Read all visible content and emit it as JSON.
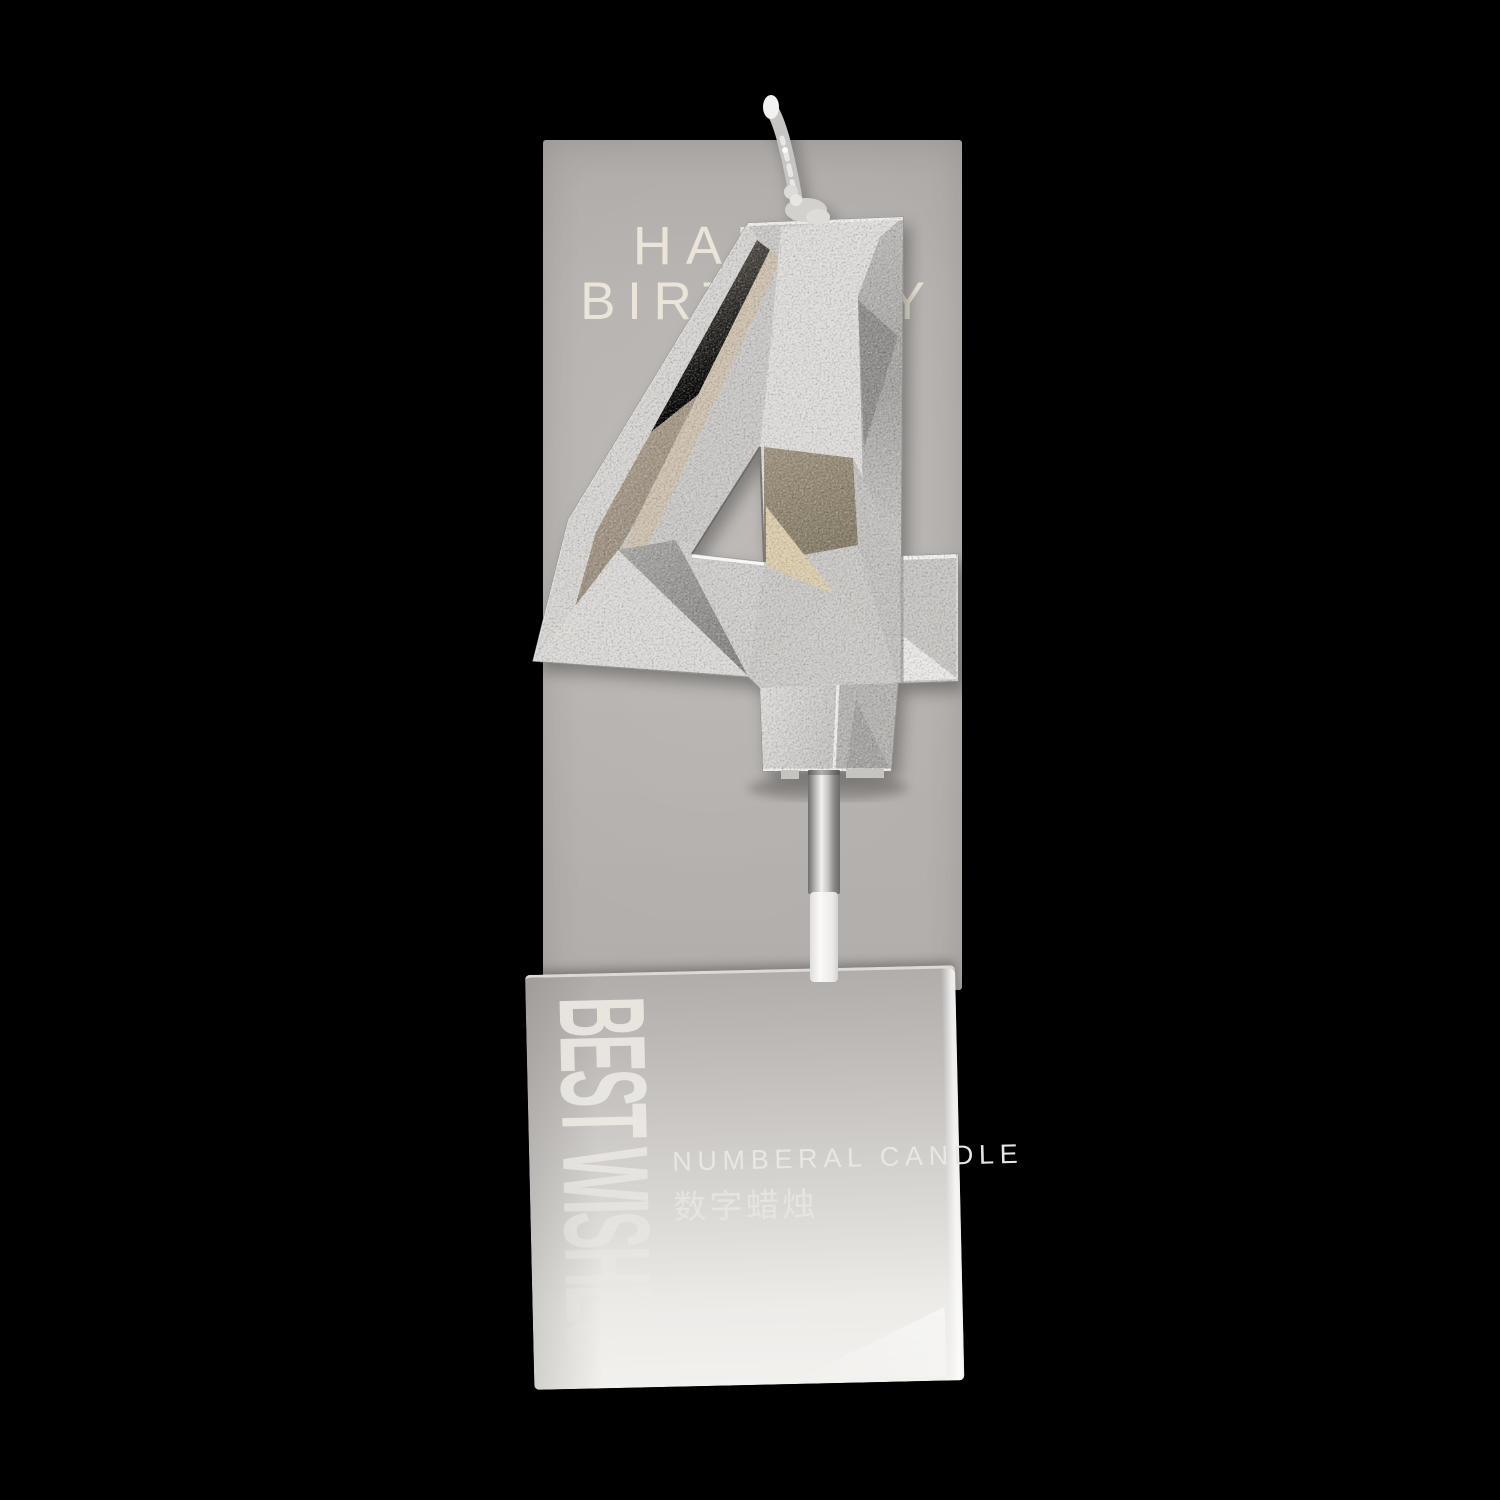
{
  "scene": {
    "background_color": "#000000"
  },
  "card": {
    "color": "#b5b1ae",
    "heading_line1": "HAPPY",
    "heading_line2": "BIRTHDAY",
    "heading_color": "#ebe4d8"
  },
  "candle": {
    "digit": "4",
    "colors": {
      "silver_base": "#c9c7c4",
      "silver_bright": "#dedcd9",
      "silver_dark": "#8d8b89",
      "tan_edge": "#a89a87",
      "taupe_facet": "#948a76",
      "champagne_facet": "#dbcdab"
    },
    "wick_color": "#d8d6d4",
    "stick": {
      "ferrule_color": "#b5b3b1",
      "stick_color": "#f2f1ee"
    }
  },
  "box": {
    "gradient_top": "#b0adaa",
    "gradient_bottom": "#f3f1ee",
    "side_text": "BEST WISHES",
    "side_text_color": "#efece6",
    "product_name_en": "NUMBERAL CANDLE",
    "product_name_zh": "数字蜡烛",
    "product_name_color": "#e9e7e3"
  }
}
